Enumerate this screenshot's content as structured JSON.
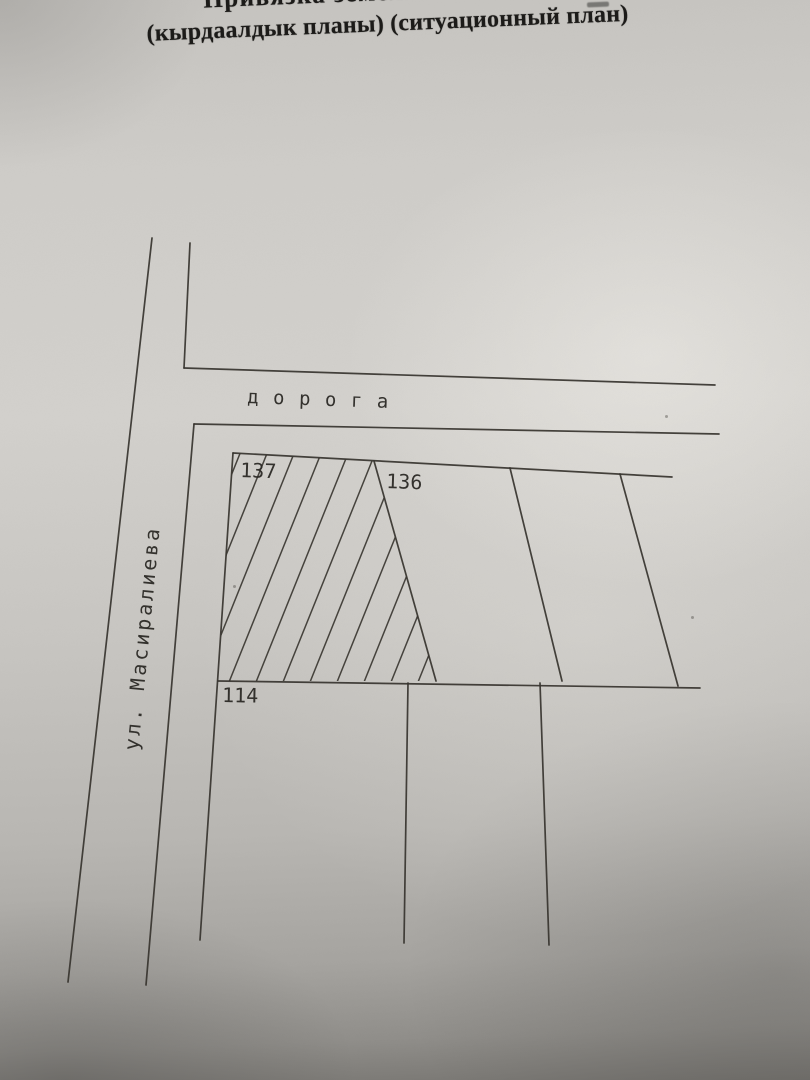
{
  "page": {
    "title_line1": "Привязка земель",
    "title_line2": "(кырдаалдык планы) (ситуационный план)"
  },
  "plan": {
    "road_label": "дорога",
    "street_label": "ул. Масиралиева",
    "plots": [
      {
        "id": "137",
        "hatched": true
      },
      {
        "id": "136",
        "hatched": false
      },
      {
        "id": "114",
        "hatched": false
      }
    ]
  },
  "colors": {
    "paper": "#d1cfca",
    "ink": "#37342e",
    "title_ink": "#1b1a18"
  }
}
